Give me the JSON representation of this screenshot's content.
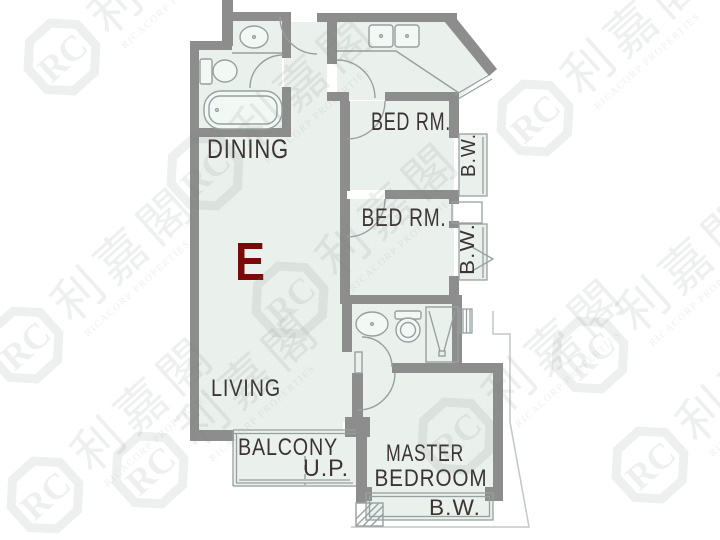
{
  "title": "Floor plan unit E",
  "labels": {
    "unit": "E",
    "dining": "DINING",
    "living": "LIVING",
    "balcony": "BALCONY",
    "up": "U.P.",
    "bed_rm_1": "BED RM.",
    "bed_rm_2": "BED RM.",
    "bw_1": "B.W.",
    "bw_2": "B.W.",
    "bw_master": "B.W.",
    "master_line1": "MASTER",
    "master_line2": "BEDROOM"
  },
  "watermark": {
    "logo": "RC",
    "chinese": "利嘉閣",
    "company": "RICACORP PROPERTIES"
  },
  "colors": {
    "background": "#ffffff",
    "floor": "#eaf1ec",
    "wall": "#8d8d8d",
    "fixture": "#97a0a0",
    "label": "#3b3433",
    "unit_letter": "#7a0909",
    "thin_outline": "#c3c7c5",
    "watermark": "rgba(125,132,128,0.13)"
  }
}
